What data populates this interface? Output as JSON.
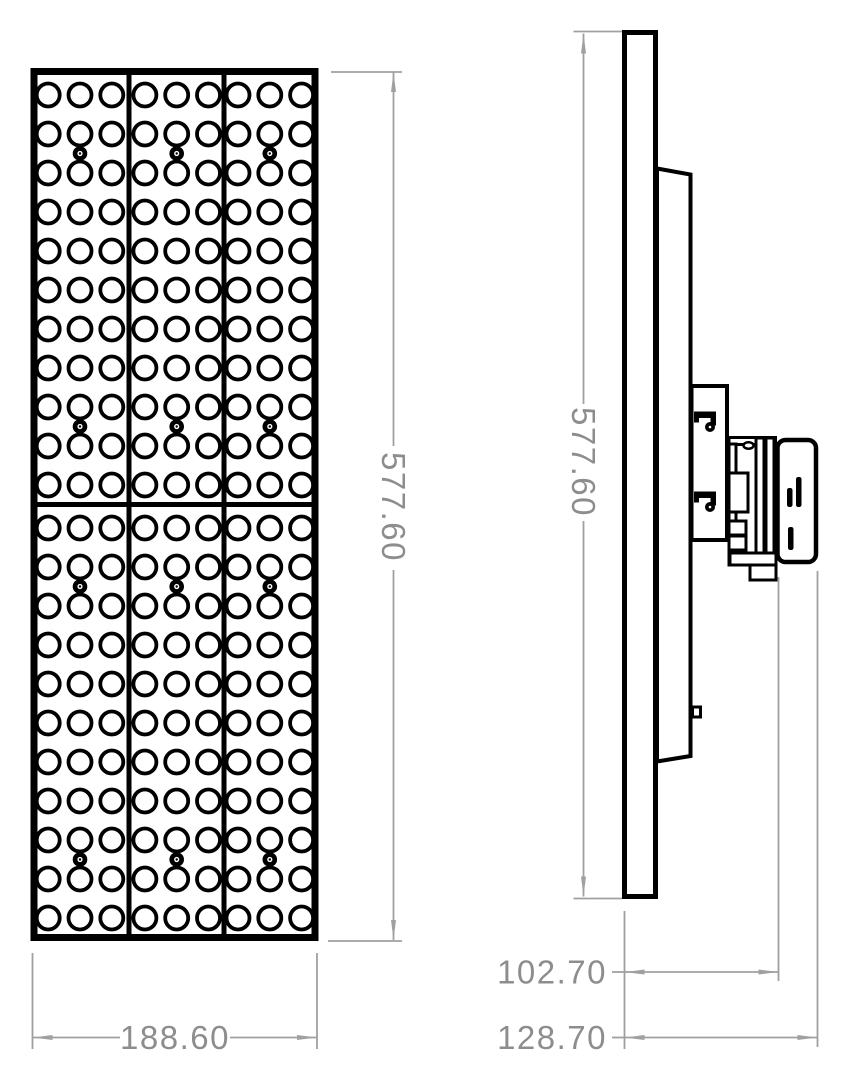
{
  "dimensions": {
    "front_height": "577.60",
    "front_width": "188.60",
    "side_height": "577.60",
    "depth_to_mount": "102.70",
    "depth_overall": "128.70"
  },
  "front_view": {
    "modules": {
      "columns": 3,
      "rows": 2
    },
    "holes_per_module": {
      "columns": 3,
      "rows": 11
    },
    "screws_per_module": 2
  },
  "colors": {
    "line": "#000000",
    "dimension_line": "#a0a0a0",
    "dimension_text": "#8d8d8d",
    "background": "#ffffff"
  }
}
